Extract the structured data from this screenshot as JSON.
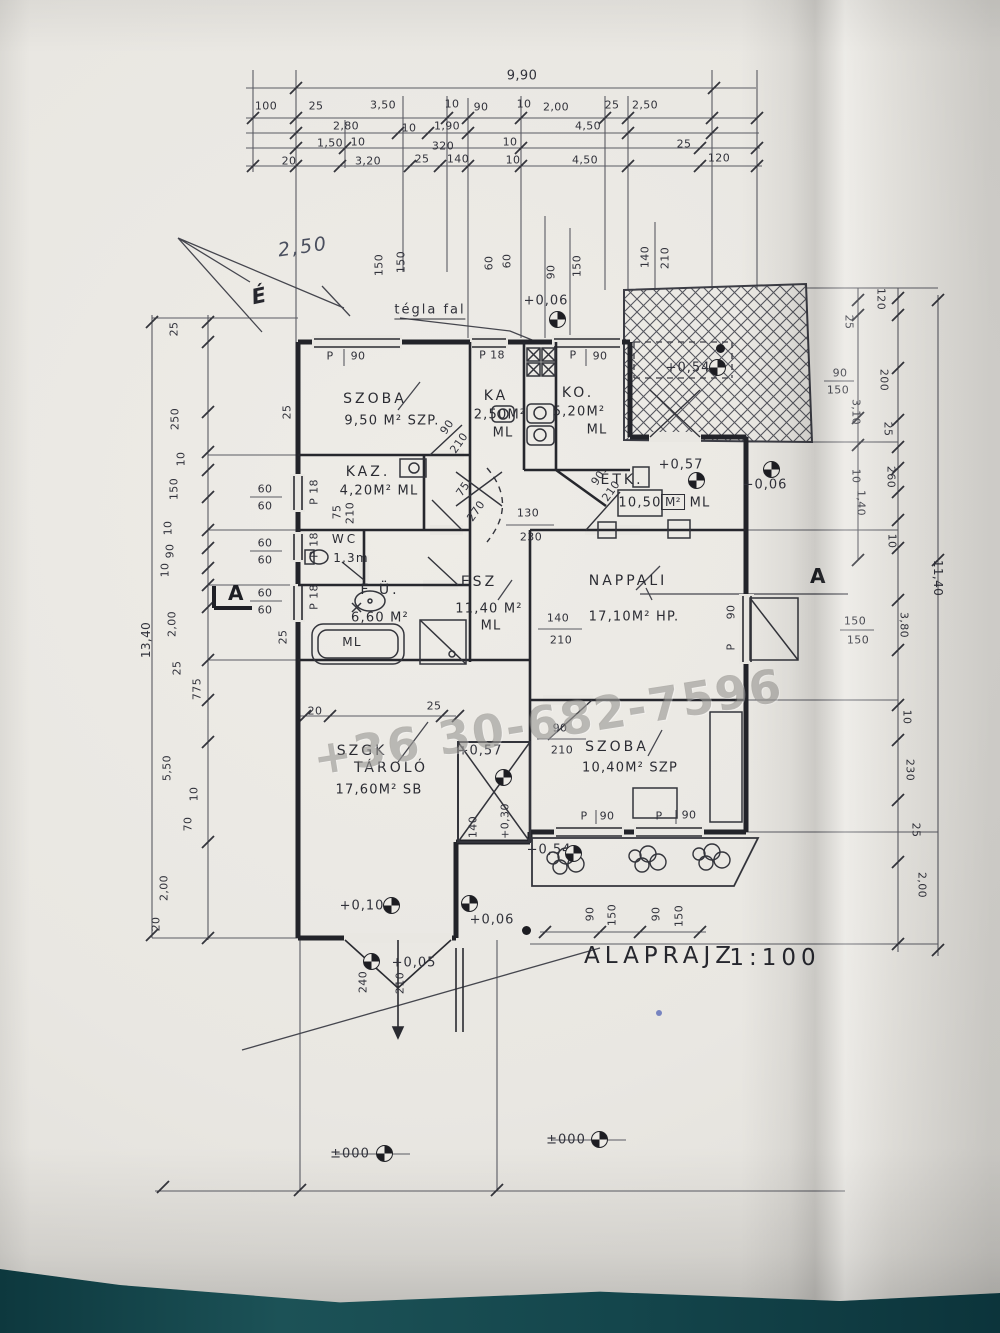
{
  "title": {
    "label": "ALAPRAJZ",
    "scale": "1:100"
  },
  "watermark": "+36 30-682-7596",
  "notes": {
    "wall": "tégla fal",
    "north": "É",
    "hand": "2,50"
  },
  "rooms": [
    {
      "name": "SZOBA",
      "sub": "9,50 M² SZP."
    },
    {
      "name": "KA",
      "sub": "2,50M²",
      "code": "ML"
    },
    {
      "name": "KO.",
      "sub": "5,20M²",
      "code": "ML"
    },
    {
      "name": "KAZ.",
      "sub": "4,20M² ML"
    },
    {
      "name": "WC",
      "sub": "1,3m"
    },
    {
      "name": "F Ü.",
      "sub": "6,60 M²"
    },
    {
      "name": "ESZ",
      "sub": "11,40 M²",
      "code": "ML"
    },
    {
      "name": "ÉTK.",
      "sub": "10,50",
      "unit": "M²",
      "code": "ML"
    },
    {
      "name": "NAPPALI",
      "sub": "17,10M² HP."
    },
    {
      "name": "SZGK",
      "name2": "TÁROLÓ",
      "sub": "17,60M² SB"
    },
    {
      "name": "SZOBA",
      "sub": "10,40M² SZP"
    }
  ],
  "elev": {
    "top": "+0,06",
    "right": "+0,06",
    "terrace": "+0,54",
    "etk": "+0,57",
    "steps": "+0,57",
    "steps_h": "+0,30",
    "planter": "+0,54",
    "garage": "+0,10",
    "yard": "+0,06",
    "ramp": "+0,05",
    "g1": "±000",
    "g2": "±000"
  },
  "dims": {
    "top": {
      "total": "9,90",
      "row2": [
        "100",
        "25",
        "3,50",
        "10",
        "90",
        "10",
        "2,00",
        "25",
        "2,50"
      ],
      "row3": [
        "2,80",
        "10",
        "1,90",
        "4,50"
      ],
      "row4": [
        "1,50",
        "10",
        "320",
        "10",
        "25"
      ],
      "row5": [
        "20",
        "3,20",
        "25",
        "140",
        "10",
        "4,50",
        "120"
      ]
    },
    "left": {
      "total": "13,40",
      "chain": [
        "25",
        "250",
        "10",
        "150",
        "10",
        "90",
        "10",
        "2,00",
        "25",
        "775",
        "5,50",
        "10",
        "70",
        "2,00",
        "20"
      ],
      "sixty": [
        "60",
        "60",
        "60",
        "60",
        "60",
        "60"
      ],
      "extra": [
        "25",
        "25",
        "20",
        "25"
      ]
    },
    "right": {
      "total": "11,40",
      "chain": [
        "120",
        "25",
        "200",
        "3,10",
        "25",
        "260",
        "10",
        "1,40",
        "10",
        "3,80",
        "10",
        "230",
        "25",
        "2,00"
      ],
      "fracs": [
        "90",
        "150",
        "150",
        "150"
      ]
    },
    "plan_top": [
      "150",
      "150",
      "60",
      "60",
      "90",
      "150",
      "140",
      "210"
    ],
    "planter": [
      "90",
      "150",
      "90",
      "150"
    ],
    "steps": [
      "140"
    ],
    "doors": {
      "d0": [
        "90",
        "210"
      ],
      "d1": [
        "75",
        "270"
      ],
      "d2": [
        "130",
        "230"
      ],
      "d3": [
        "140",
        "210"
      ],
      "d4": [
        "90",
        "210"
      ],
      "d5": [
        "240",
        "210"
      ],
      "d6": [
        "75",
        "210"
      ],
      "d7": [
        "90",
        "210"
      ]
    }
  },
  "win": {
    "p": "P",
    "n": "90",
    "small": "P 18"
  },
  "section": {
    "a": "A"
  },
  "fixtures": {
    "tub": "ML"
  }
}
